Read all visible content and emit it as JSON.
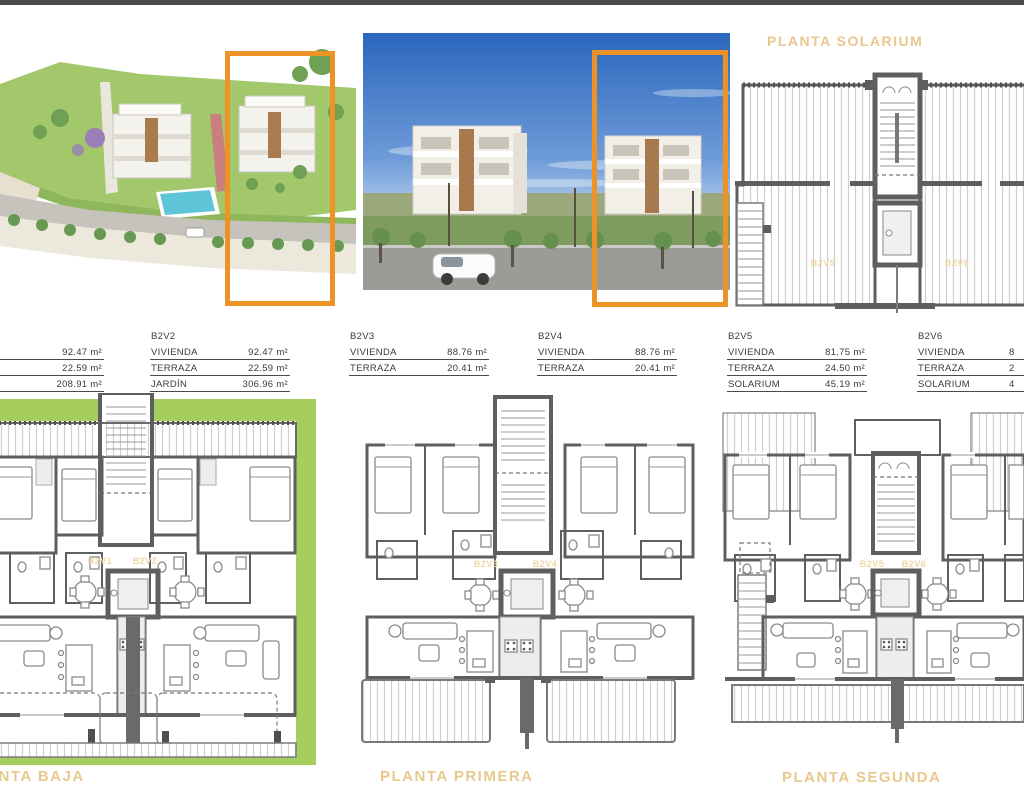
{
  "bloque": {
    "label": "BLOQUE 2"
  },
  "solarium": {
    "title": "PLANTA SOLARIUM",
    "label_left": "B2V5",
    "label_right": "B2V6"
  },
  "tables": [
    {
      "id": "",
      "rows": [
        {
          "label": "",
          "value": "92.47 m²"
        },
        {
          "label": "",
          "value": "22.59 m²"
        },
        {
          "label": "",
          "value": "208.91 m²"
        }
      ]
    },
    {
      "id": "B2V2",
      "rows": [
        {
          "label": "VIVIENDA",
          "value": "92.47 m²"
        },
        {
          "label": "TERRAZA",
          "value": "22.59 m²"
        },
        {
          "label": "JARDÍN",
          "value": "306.96 m²"
        }
      ]
    },
    {
      "id": "B2V3",
      "rows": [
        {
          "label": "VIVIENDA",
          "value": "88.76 m²"
        },
        {
          "label": "TERRAZA",
          "value": "20.41 m²"
        }
      ]
    },
    {
      "id": "B2V4",
      "rows": [
        {
          "label": "VIVIENDA",
          "value": "88.76 m²"
        },
        {
          "label": "TERRAZA",
          "value": "20.41 m²"
        }
      ]
    },
    {
      "id": "B2V5",
      "rows": [
        {
          "label": "VIVIENDA",
          "value": "81.75 m²"
        },
        {
          "label": "TERRAZA",
          "value": "24.50 m²"
        },
        {
          "label": "SOLARIUM",
          "value": "45.19 m²"
        }
      ]
    },
    {
      "id": "B2V6",
      "rows": [
        {
          "label": "VIVIENDA",
          "value": "8"
        },
        {
          "label": "TERRAZA",
          "value": "2"
        },
        {
          "label": "SOLARIUM",
          "value": "4"
        }
      ]
    }
  ],
  "plans": {
    "baja": {
      "title": "PLANTA BAJA",
      "label_left": "B2V1",
      "label_right": "B2V2"
    },
    "primera": {
      "title": "PLANTA PRIMERA",
      "label_left": "B2V3",
      "label_right": "B2V4"
    },
    "segunda": {
      "title": "PLANTA SEGUNDA",
      "label_left": "B2V5",
      "label_right": "B2V6"
    }
  },
  "colors": {
    "accent_orange": "#ec9226",
    "title_tan": "#e9c88e",
    "faint_unit_label": "#efd7a6",
    "garden_green": "#a6ce5f",
    "sky_blue": "#2b66bd",
    "topbar_gray": "#4a4a4a"
  }
}
